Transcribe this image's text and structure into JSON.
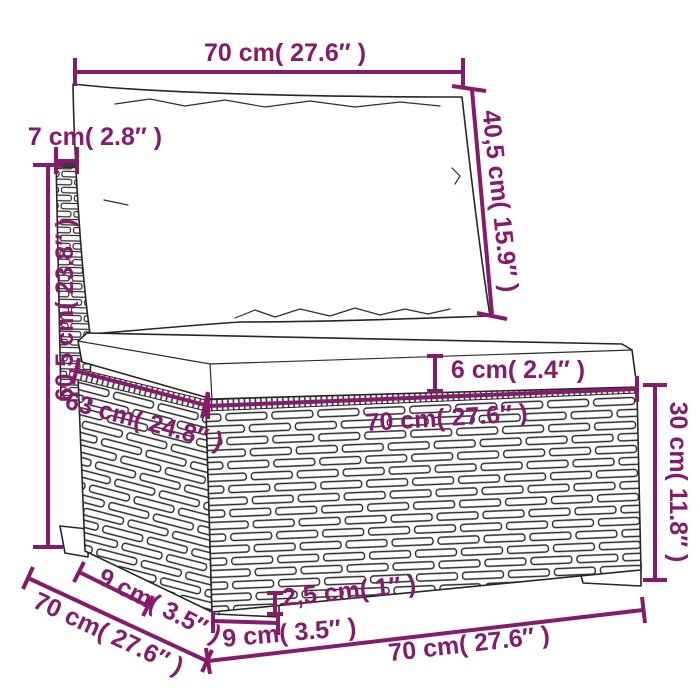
{
  "figure": {
    "description": "Dimension diagram of a poly rattan sofa middle section with back cushion and seat cushion",
    "accent_color": "#871B6B",
    "line_color": "#262626",
    "background_color": "#ffffff"
  },
  "measurements": {
    "back_cushion_width": {
      "label": "70 cm( 27.6″ )",
      "cm": 70,
      "inches": 27.6
    },
    "backrest_thickness": {
      "label": "7 cm( 2.8″ )",
      "cm": 7,
      "inches": 2.8
    },
    "back_cushion_height": {
      "label": "40,5 cm( 15.9″ )",
      "cm": 40.5,
      "inches": 15.9
    },
    "total_height": {
      "label": "60,5 cm( 23.8″ )",
      "cm": 60.5,
      "inches": 23.8
    },
    "seat_cushion_thickness": {
      "label": "6 cm( 2.4″ )",
      "cm": 6,
      "inches": 2.4
    },
    "seat_depth": {
      "label": "63 cm( 24.8″ )",
      "cm": 63,
      "inches": 24.8
    },
    "seat_width": {
      "label": "70 cm( 27.6″ )",
      "cm": 70,
      "inches": 27.6
    },
    "base_height": {
      "label": "30 cm( 11.8″ )",
      "cm": 30,
      "inches": 11.8
    },
    "foot_side_width": {
      "label": "9 cm( 3.5″ )",
      "cm": 9,
      "inches": 3.5
    },
    "base_depth": {
      "label": "70 cm( 27.6″ )",
      "cm": 70,
      "inches": 27.6
    },
    "foot_height": {
      "label": "2,5 cm( 1″ )",
      "cm": 2.5,
      "inches": 1
    },
    "foot_front_width": {
      "label": "9 cm( 3.5″ )",
      "cm": 9,
      "inches": 3.5
    },
    "base_width": {
      "label": "70 cm( 27.6″ )",
      "cm": 70,
      "inches": 27.6
    }
  }
}
